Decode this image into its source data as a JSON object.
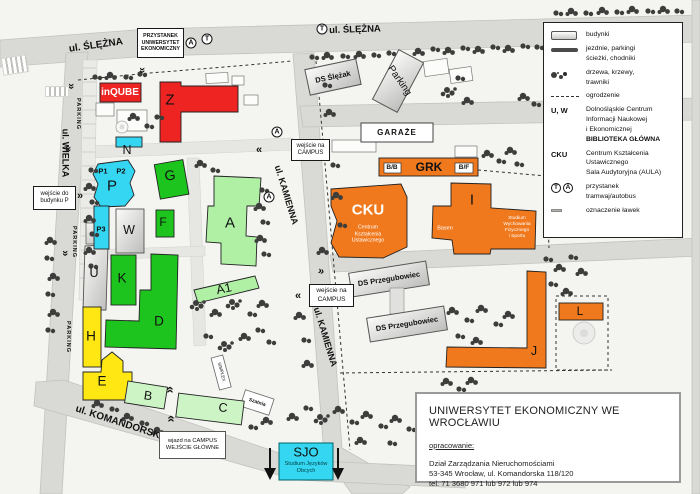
{
  "palette": {
    "red": "#ee2423",
    "green": "#1ec41e",
    "light_green": "#aff0a5",
    "pale_green": "#cdf4c5",
    "cyan": "#35d6f2",
    "yellow": "#ffe714",
    "orange": "#f1791d",
    "road": "#d9d9d6",
    "ground": "#f4f4f1",
    "tree": "#3d3d3c"
  },
  "streets": {
    "slezna": "ul. ŚLĘŻNA",
    "wielka": "ul. WIELKA",
    "kamienna": "ul. KAMIENNA",
    "komandorska": "ul. KOMANDORSKA",
    "parking_strip": "PARKING"
  },
  "stops": {
    "tram": "T",
    "bus": "A"
  },
  "boxes": {
    "przystanek": {
      "l1": "PRZYSTANEK",
      "l2": "UNIWERSYTET",
      "l3": "EKONOMICZNY"
    },
    "wejscie_p": {
      "l1": "wejście do",
      "l2": "budynku P"
    },
    "wejscie_campus": {
      "l1": "wejście na",
      "l2": "CAMPUS"
    },
    "wjazd": {
      "l1": "wjazd na CAMPUS",
      "l2": "WEJŚCIE GŁÓWNE"
    }
  },
  "buildings": {
    "inqube": "inQUBE",
    "z": "Z",
    "n": "N",
    "p": "P",
    "p1": "P1",
    "p2": "P2",
    "p3": "P3",
    "w": "W",
    "u": "U",
    "k": "K",
    "d": "D",
    "g": "G",
    "f": "F",
    "a": "A",
    "a1": "A1",
    "h": "H",
    "e": "E",
    "b": "B",
    "c": "C",
    "j": "J",
    "l": "L",
    "i": "I",
    "cku": {
      "label": "CKU",
      "l1": "Centrum",
      "l2": "Kształcenia",
      "l3": "Ustawicznego"
    },
    "grk": {
      "label": "GRK",
      "bb": "B/B",
      "bf": "B/F"
    },
    "i_info": {
      "basen": "Basen",
      "s1": "Studium",
      "s2": "Wychowania",
      "s3": "Fizycznego",
      "s4": "i Sportu"
    },
    "sjo": {
      "label": "SJO",
      "l1": "Studium Języków",
      "l2": "Obcych"
    },
    "ds_slezak": "DS Ślężak",
    "parking_bldg": "Parking",
    "garaze": "GARAŻE",
    "ds_przegubowiec": "DS Przegubowiec",
    "simplex": "SIMPLEX",
    "szatnia": "Szatnia"
  },
  "legend": {
    "items": [
      {
        "label": "budynki"
      },
      {
        "label": "jezdnie, parkingi",
        "label2": "ścieżki, chodniki"
      },
      {
        "label": "drzewa, krzewy,",
        "label2": "trawniki"
      },
      {
        "label": "ogrodzenie"
      },
      {
        "key": "U, W",
        "l1": "Dolnośląskie Centrum",
        "l2": "Informacji Naukowej",
        "l3": "i Ekonomicznej",
        "l4": "BIBLIOTEKA GŁÓWNA"
      },
      {
        "key": "CKU",
        "l1": "Centrum Kształcenia",
        "l2": "Ustawicznego",
        "l3": "Sala Audytoryjna (AULA)"
      },
      {
        "l1": "przystanek",
        "l2": "tramwaj/autobus"
      },
      {
        "label": "oznaczenie ławek"
      }
    ]
  },
  "info_box": {
    "title": "UNIWERSYTET EKONOMICZNY WE WROCŁAWIU",
    "heading": "opracowanie:",
    "line1": "Dział Zarządzania Nieruchomościami",
    "line2": "53-345 Wrocław, ul. Komandorska 118/120",
    "line3": "tel. 71 3680 971 lub 972 lub 974"
  }
}
